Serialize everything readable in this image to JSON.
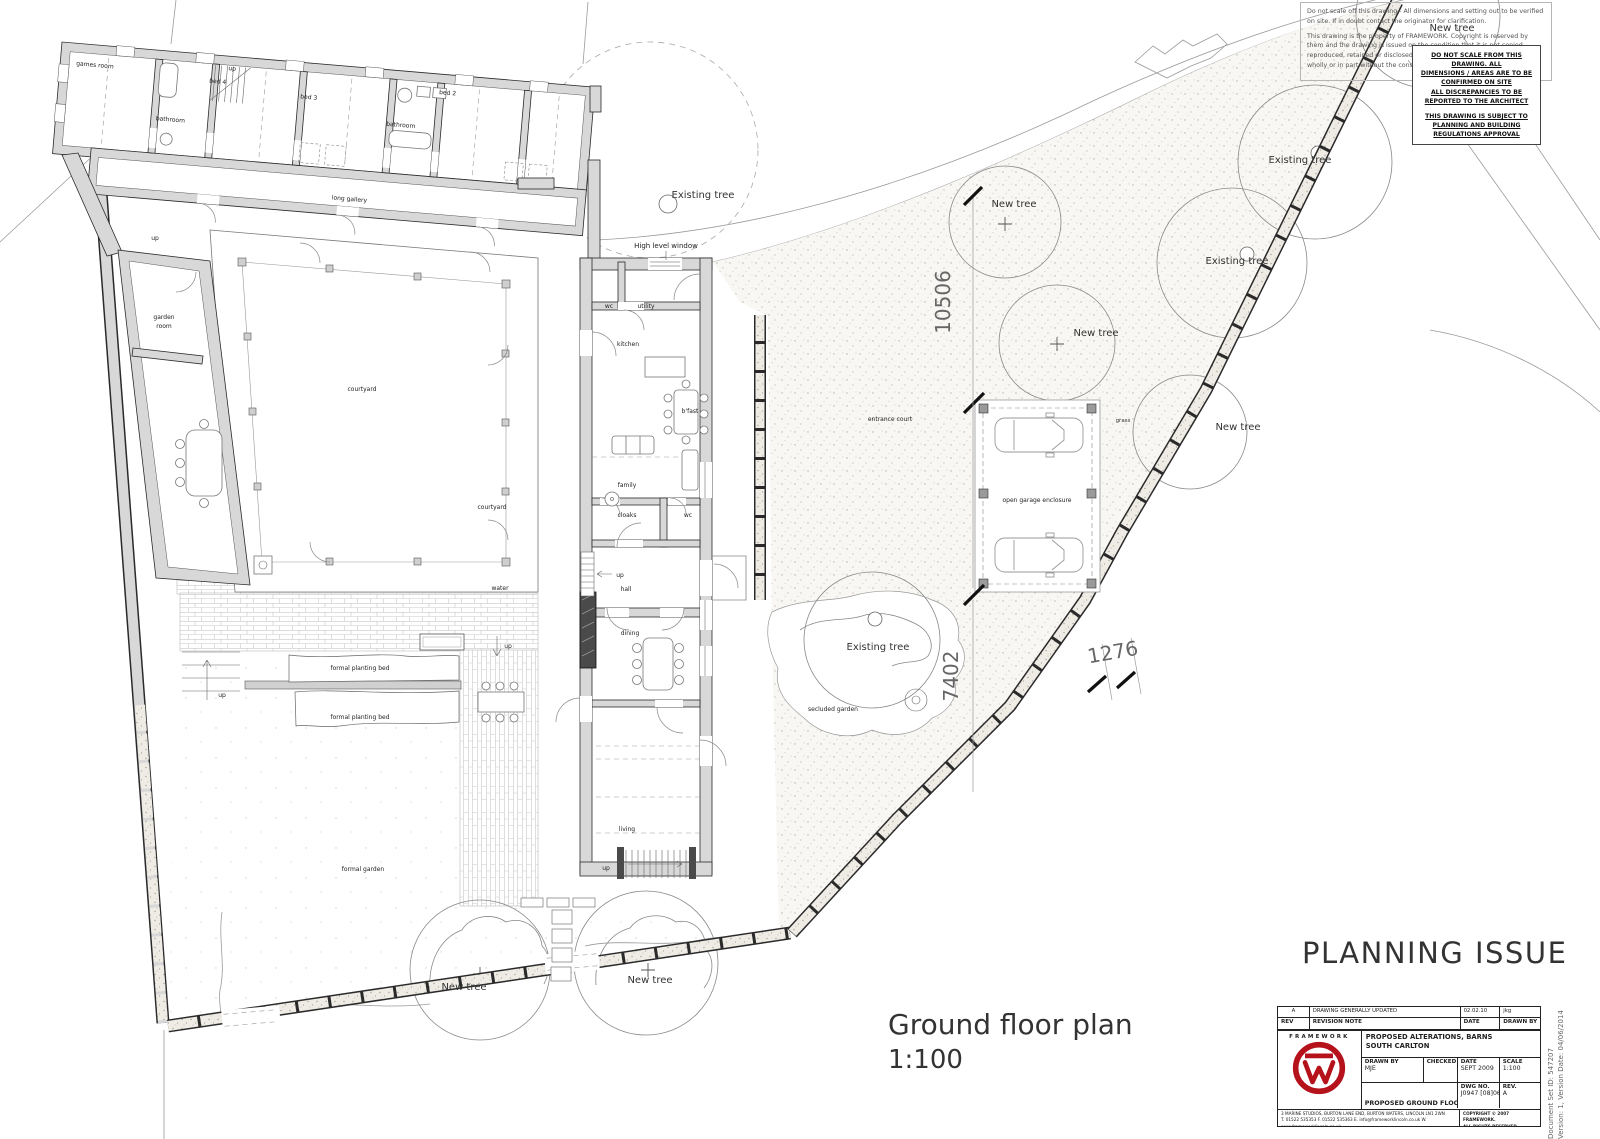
{
  "sheet": {
    "notes": {
      "p1": "Do not scale off this drawing - All dimensions and setting out to be verified on site. If in doubt contact the originator for clarification.",
      "p2": "This drawing is the property of FRAMEWORK. Copyright is reserved by them and the drawing is issued on the condition that it is not copied, reproduced, retained or disclosed to any unauthorised person, either wholly or in part without the consent in writing of FRAMEWORK."
    },
    "warning": {
      "l1": "DO NOT SCALE FROM THIS DRAWING. ALL",
      "l2": "DIMENSIONS / AREAS ARE TO BE CONFIRMED ON SITE",
      "l3": "ALL DISCREPANCIES TO BE REPORTED TO THE ARCHITECT",
      "l4": "THIS DRAWING IS SUBJECT TO",
      "l5": "PLANNING AND BUILDING REGULATIONS APPROVAL"
    },
    "stamp": "PLANNING ISSUE",
    "caption": {
      "title": "Ground floor plan",
      "scale": "1:100"
    },
    "docmeta": {
      "l1": "Document Set ID: 547207",
      "l2": "Version: 1, Version Date: 04/06/2014"
    }
  },
  "titleblock": {
    "rev_row": {
      "rev": "A",
      "note": "DRAWING GENERALLY UPDATED",
      "date": "02.02.10",
      "by": "jkg"
    },
    "head_row": {
      "rev": "REV",
      "note": "REVISION NOTE",
      "date": "DATE",
      "by": "DRAWN BY"
    },
    "brand": "FRAMEWORK",
    "project1": "PROPOSED ALTERATIONS, BARNS",
    "project2": "SOUTH CARLTON",
    "labels": {
      "drawn_by": "DRAWN BY",
      "checked": "CHECKED",
      "date": "DATE",
      "scale": "SCALE",
      "dwg_no": "DWG NO.",
      "rev": "REV."
    },
    "values": {
      "drawn_by": "MJE",
      "checked": "",
      "date": "SEPT 2009",
      "scale": "1:100",
      "dwg_no": "J0947 [08]06",
      "rev": "A"
    },
    "title": "PROPOSED GROUND FLOOR PLAN",
    "address1": "3 MARINE STUDIOS, BURTON LANE END, BURTON WATERS, LINCOLN  LN1 2WN",
    "address2": "T. 01522 535353  F. 01522 535363  E. info@frameworklincoln.co.uk  W. www.frameworklincoln.co.uk",
    "copyright1": "COPYRIGHT © 2007 FRAMEWORK.",
    "copyright2": "ALL RIGHTS RESERVED."
  },
  "plan": {
    "rooms": {
      "games_room": "games room",
      "up": "up",
      "bed4": "bed 4",
      "bed3": "bed 3",
      "bed2": "bed 2",
      "bathroom": "bathroom",
      "long_gallery": "long gallery",
      "garden_l1": "garden",
      "garden_l2": "room",
      "wc": "wc",
      "utility": "utility",
      "kitchen": "kitchen",
      "bfast": "b'fast",
      "family": "family",
      "cloaks": "cloaks",
      "hall": "hall",
      "dining": "dining",
      "living": "living",
      "high_level_window": "High level window"
    },
    "site": {
      "courtyard": "courtyard",
      "water": "water",
      "formal_planting_bed": "formal planting bed",
      "formal_garden": "formal garden",
      "entrance_court": "entrance court",
      "open_garage": "open garage enclosure",
      "grass": "grass",
      "secluded_garden": "secluded garden"
    },
    "trees": {
      "new_tree": "New tree",
      "existing_tree": "Existing tree"
    },
    "dims": {
      "d10506": "10506",
      "d7402": "7402",
      "d1276": "1276"
    }
  },
  "colors": {
    "logo_red": "#b5121b",
    "wall_gray": "#d8d8d8",
    "ink": "#2a2a2a"
  }
}
